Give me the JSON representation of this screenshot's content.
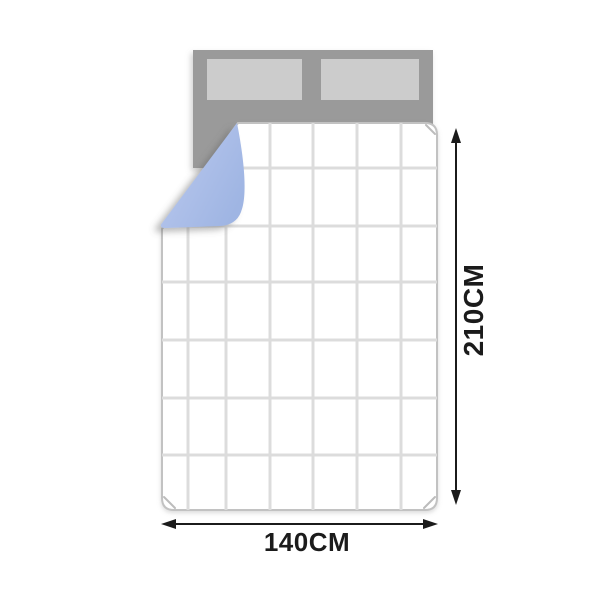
{
  "diagram": {
    "type": "product-dimension-diagram",
    "subject": "quilt on bed with folded corner",
    "dimensions": {
      "height_label": "210CM",
      "width_label": "140CM"
    }
  },
  "colors": {
    "background": "#ffffff",
    "headboard_gray": "#9a9a9a",
    "pillow_gray": "#cccccc",
    "quilt_white": "#ffffff",
    "quilt_outline": "#c2c2c2",
    "grid_line": "#dcdcdc",
    "fold_blue_light": "#bccaef",
    "fold_blue_dark": "#9fb5e3",
    "arrow_black": "#1b1b1b"
  }
}
